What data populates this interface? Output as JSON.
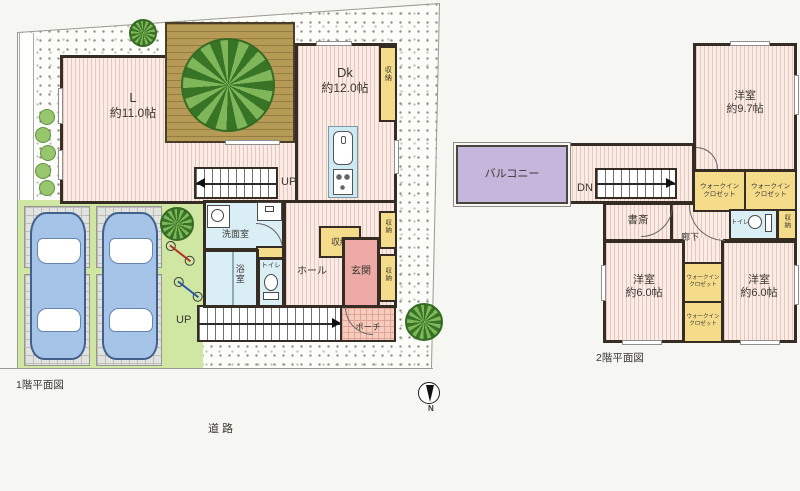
{
  "meta": {
    "caption_floor1": "1階平面図",
    "caption_floor2": "2階平面図",
    "road": "道路",
    "north": "N"
  },
  "floor1": {
    "living": {
      "name": "L",
      "size": "約11.0帖"
    },
    "dining_kitchen": {
      "name": "Dk",
      "size": "約12.0帖"
    },
    "washroom": "洗面室",
    "bath": "浴室",
    "toilet": "トイレ",
    "hall": "ホール",
    "entrance": "玄関",
    "porch": "ポーチ",
    "storage": "収納",
    "stairs_up": "UP",
    "approach_up": "UP"
  },
  "floor2": {
    "bedroom_main": {
      "name": "洋室",
      "size": "約9.7帖"
    },
    "bedroom_small": {
      "name": "洋室",
      "size": "約6.0帖"
    },
    "study": "書斎",
    "corridor": "廊下",
    "balcony": "バルコニー",
    "wic": {
      "line1": "ウォークイン",
      "line2": "クロゼット"
    },
    "toilet": "トイレ",
    "storage": "収納",
    "stairs_down": "DN"
  },
  "palette": {
    "floor_pink": "#f9ece6",
    "wall_dark": "#352c24",
    "storage_yellow": "#f5dc8a",
    "wet_blue": "#daeef5",
    "entrance_pink": "#eda9a4",
    "balcony_purple": "#c5b7db",
    "lawn_green": "#cfe7a2",
    "deck_brown": "#b59b55",
    "car_blue": "#a6c4e7"
  }
}
